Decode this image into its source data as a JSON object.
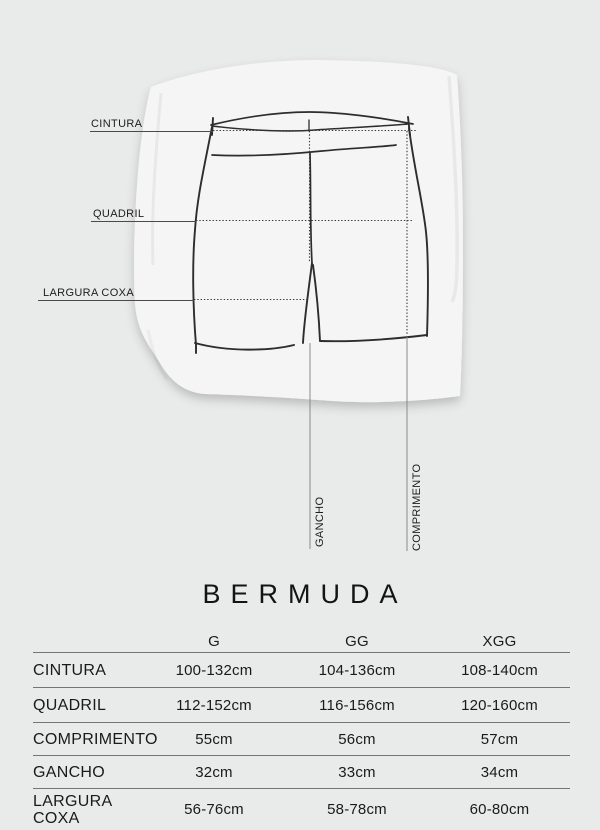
{
  "colors": {
    "background": "#e9eaea",
    "paper": "#f5f5f5",
    "sketch_ink": "#2d2d2d",
    "measure_line": "#8a8a8a",
    "table_rule": "#757575",
    "text": "#1a1a1a"
  },
  "diagram": {
    "labels": {
      "cintura": "CINTURA",
      "quadril": "QUADRIL",
      "largura_coxa": "LARGURA COXA",
      "gancho": "GANCHO",
      "comprimento": "COMPRIMENTO"
    }
  },
  "title": "BERMUDA",
  "size_table": {
    "columns": [
      "G",
      "GG",
      "XGG"
    ],
    "rows": [
      {
        "label": "CINTURA",
        "values": [
          "100-132cm",
          "104-136cm",
          "108-140cm"
        ]
      },
      {
        "label": "QUADRIL",
        "values": [
          "112-152cm",
          "116-156cm",
          "120-160cm"
        ]
      },
      {
        "label": "COMPRIMENTO",
        "values": [
          "55cm",
          "56cm",
          "57cm"
        ]
      },
      {
        "label": "GANCHO",
        "values": [
          "32cm",
          "33cm",
          "34cm"
        ]
      },
      {
        "label": "LARGURA COXA",
        "values": [
          "56-76cm",
          "58-78cm",
          "60-80cm"
        ]
      }
    ]
  },
  "chart_data": {
    "type": "table",
    "title": "BERMUDA",
    "columns": [
      "",
      "G",
      "GG",
      "XGG"
    ],
    "rows": [
      [
        "CINTURA",
        "100-132cm",
        "104-136cm",
        "108-140cm"
      ],
      [
        "QUADRIL",
        "112-152cm",
        "116-156cm",
        "120-160cm"
      ],
      [
        "COMPRIMENTO",
        "55cm",
        "56cm",
        "57cm"
      ],
      [
        "GANCHO",
        "32cm",
        "33cm",
        "34cm"
      ],
      [
        "LARGURA COXA",
        "56-76cm",
        "58-78cm",
        "60-80cm"
      ]
    ]
  }
}
